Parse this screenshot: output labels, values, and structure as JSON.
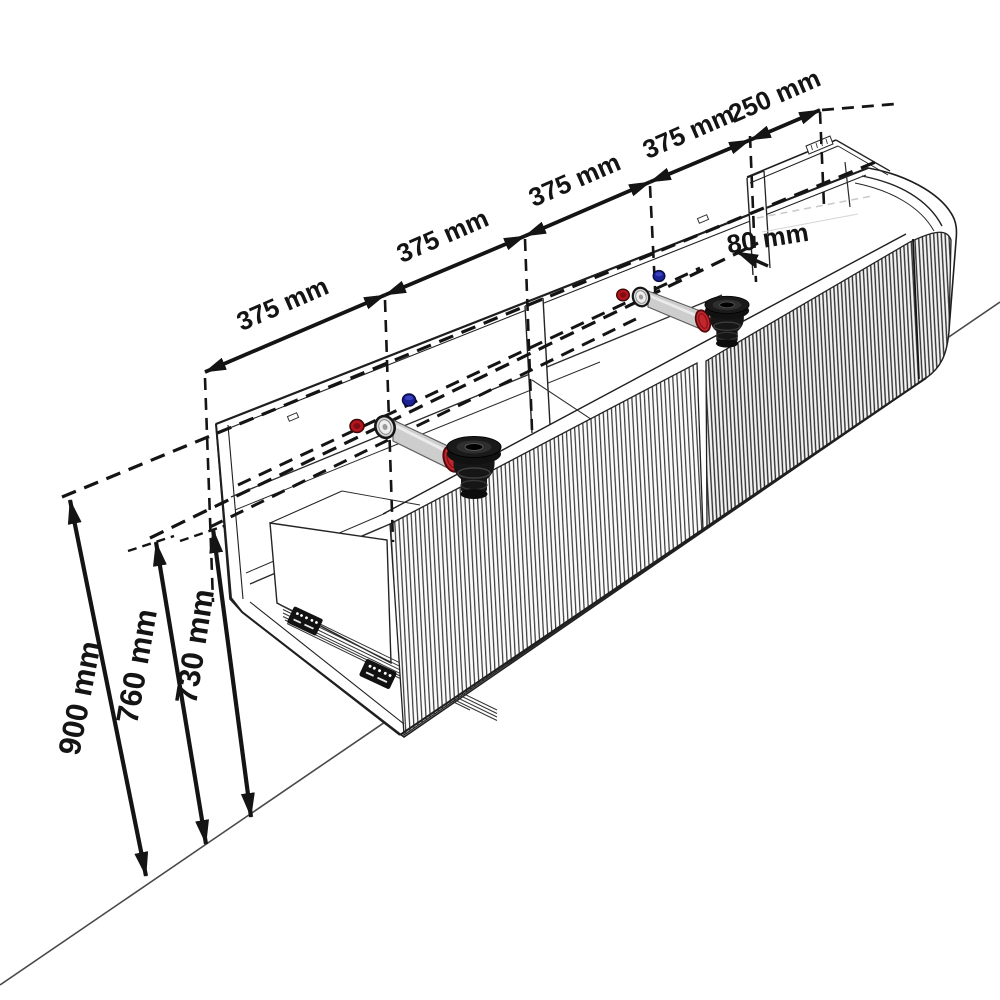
{
  "diagram": {
    "type": "isometric-technical-drawing",
    "subject": "double washbasin vanity unit with fluted front, open drawer section, water valves and drain traps",
    "width_dimensions": {
      "segments": [
        {
          "id": "seg-1",
          "label": "375 mm"
        },
        {
          "id": "seg-2",
          "label": "375 mm"
        },
        {
          "id": "seg-3",
          "label": "375 mm"
        },
        {
          "id": "seg-4",
          "label": "375 mm"
        },
        {
          "id": "seg-5",
          "label": "250 mm"
        }
      ]
    },
    "detail_dimension": {
      "label": "80 mm"
    },
    "height_dimensions": [
      {
        "id": "h-total",
        "label": "900 mm"
      },
      {
        "id": "h-mid",
        "label": "760 mm"
      },
      {
        "id": "h-body",
        "label": "730 mm"
      }
    ],
    "colors": {
      "line": "#1c1c1c",
      "hot_valve_red": "#b5161d",
      "cold_valve_blue": "#1c2193",
      "flange_red": "#c1272d",
      "pipe_gray": "#cdcdcd",
      "trap_black": "#141414",
      "background": "#ffffff"
    }
  }
}
